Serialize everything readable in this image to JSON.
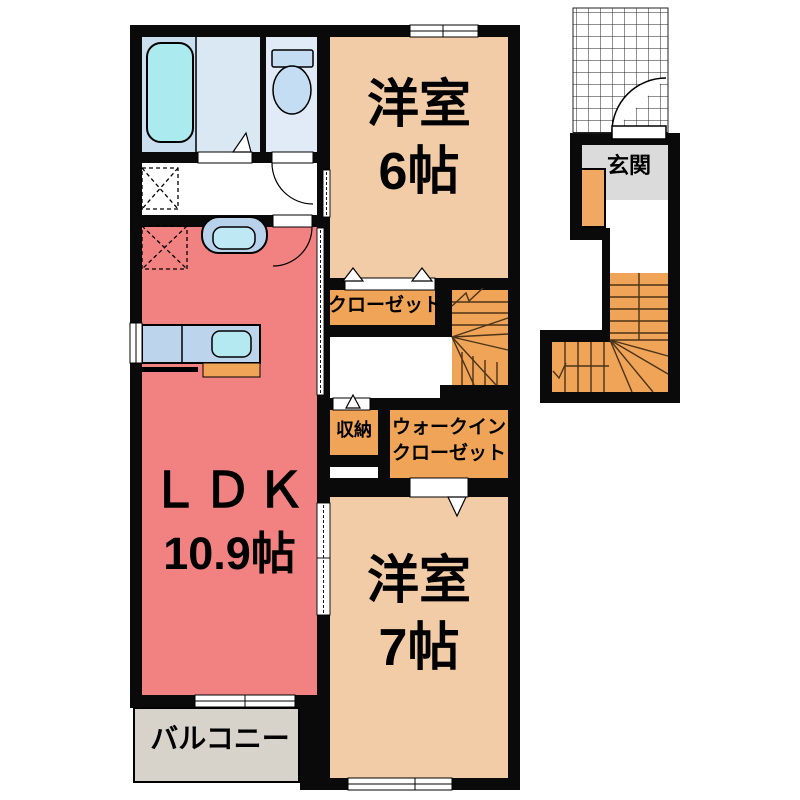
{
  "rooms": {
    "western_room_6": {
      "name": "洋室",
      "size": "6帖"
    },
    "western_room_7": {
      "name": "洋室",
      "size": "7帖"
    },
    "ldk": {
      "name": "ＬＤＫ",
      "size": "10.9帖"
    },
    "closet": {
      "name": "クローゼット"
    },
    "storage": {
      "name": "収納"
    },
    "walk_in_closet": {
      "line1": "ウォークイン",
      "line2": "クローゼット"
    },
    "entrance": {
      "name": "玄関"
    },
    "balcony": {
      "name": "バルコニー"
    }
  },
  "colors": {
    "wall": "#0a0a0a",
    "ldk_floor": "#F28282",
    "bedroom_floor": "#F2CBA7",
    "closet_floor": "#F0A457",
    "balcony_floor": "#D7D3CA",
    "entrance_floor": "#DBDBDB",
    "bathroom_floor": "#C9DEEF",
    "toilet_floor": "#E0EBF7",
    "fixture_blue": "#BDD5EC",
    "tub_cyan": "#ABEBF0",
    "shoe_cabinet": "#F0A862"
  }
}
